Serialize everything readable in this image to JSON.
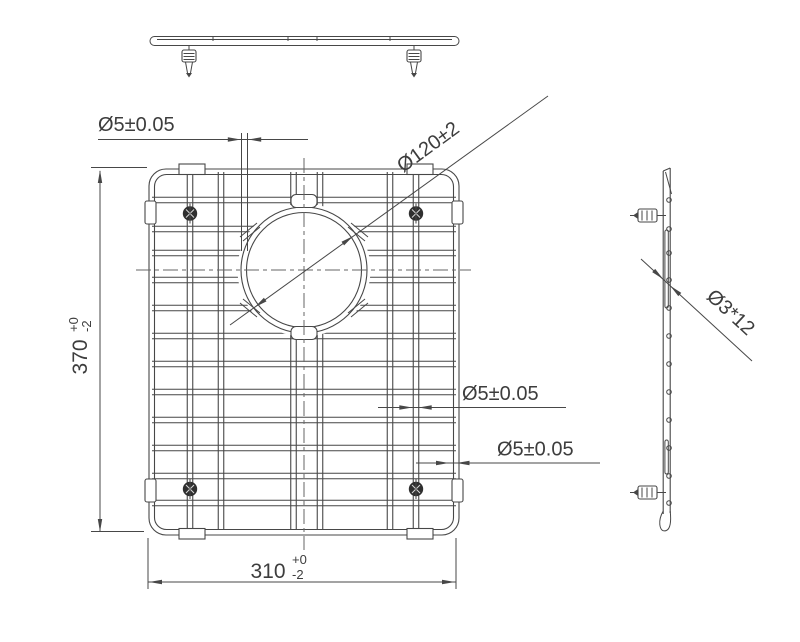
{
  "drawing_type": "technical-drawing-sink-grid",
  "style": {
    "background": "#ffffff",
    "line_color": "#474747",
    "centerline_color": "#666666",
    "text_color": "#3d3d3d"
  },
  "dimensions": {
    "ring_wire": {
      "label": "Ø5±0.05"
    },
    "hole": {
      "label": "Ø120±2"
    },
    "height": {
      "value": "370",
      "tol_plus": "+0",
      "tol_minus": "-2"
    },
    "mid_wire": {
      "label": "Ø5±0.05"
    },
    "frame_wire": {
      "label": "Ø5±0.05"
    },
    "width": {
      "value": "310",
      "tol_plus": "+0",
      "tol_minus": "-2"
    },
    "side_wires": {
      "label": "Ø3*12"
    }
  },
  "geometry": {
    "frame": {
      "x": 149,
      "y": 169,
      "width": 310,
      "height": 366,
      "corner_radius": 17,
      "wire_gauge_px": 5.5
    },
    "hole": {
      "cx": 304,
      "cy": 270,
      "r_outer": 63,
      "r_inner": 57.5
    },
    "h_wire_rows_y": [
      200,
      229,
      253,
      280,
      308,
      336,
      364,
      392,
      420,
      448,
      476,
      503
    ],
    "v_wire_cols_x": [
      190,
      221,
      293.5,
      320,
      390,
      416
    ],
    "h_wire_span_x": [
      152,
      456
    ],
    "v_wire_span_y": [
      172,
      529
    ],
    "side_view_dot_x": 669,
    "wire_count": 12
  }
}
